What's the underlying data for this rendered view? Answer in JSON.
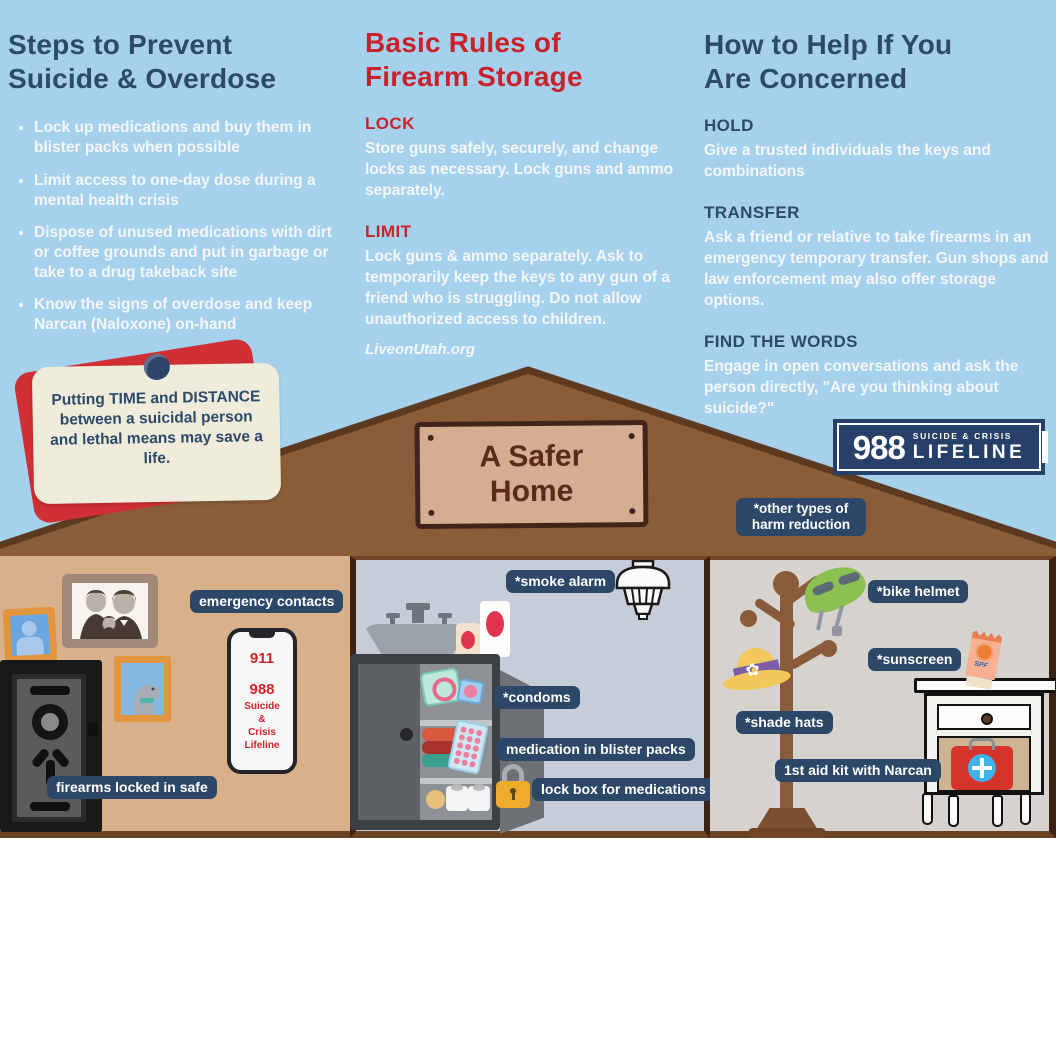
{
  "columns": {
    "prevent": {
      "title": "Steps to Prevent\nSuicide & Overdose",
      "bullets": [
        "Lock up medications and buy them in blister packs when possible",
        "Limit access to one-day dose during a mental health crisis",
        "Dispose of unused medications with dirt or coffee grounds and put in garbage or take to a drug takeback site",
        "Know the signs of overdose and keep Narcan (Naloxone) on-hand"
      ]
    },
    "firearm": {
      "title": "Basic Rules of\nFirearm Storage",
      "lock_heading": "LOCK",
      "lock_body": "Store guns safely, securely, and change locks as necessary. Lock guns and ammo separately.",
      "limit_heading": "LIMIT",
      "limit_body": "Lock guns & ammo separately. Ask to temporarily keep the keys to any gun of a friend who is struggling. Do not allow unauthorized access to children.",
      "link": "LiveonUtah.org"
    },
    "help": {
      "title": "How to Help If You\nAre Concerned",
      "hold_heading": "HOLD",
      "hold_body": "Give a trusted individuals the keys and combinations",
      "transfer_heading": "TRANSFER",
      "transfer_body": "Ask a friend or relative to take firearms in an emergency temporary transfer. Gun shops and law enforcement may also offer storage options.",
      "find_heading": "FIND THE WORDS",
      "find_body": "Engage in open conversations and ask the person directly, ",
      "find_body_bold": "\"Are you thinking about suicide?\""
    }
  },
  "note": {
    "text": "Putting TIME and DISTANCE between a suicidal person and lethal means may save a life."
  },
  "sign": {
    "text": "A Safer\nHome"
  },
  "lifeline_logo": {
    "number": "988",
    "tagline": "SUICIDE & CRISIS",
    "name": "LIFELINE"
  },
  "badges": {
    "other": "*other types of harm reduction",
    "emergency": "emergency contacts",
    "safe": "firearms locked in safe",
    "smoke": "*smoke alarm",
    "condoms": "*condoms",
    "blister": "medication in blister packs",
    "lockbox": "lock box for medications",
    "helmet": "*bike helmet",
    "sunscreen": "*sunscreen",
    "hats": "*shade hats",
    "firstaid": "1st aid kit with Narcan"
  },
  "phone": {
    "line1": "911",
    "line2": "988",
    "line3": "Suicide\n&\nCrisis\nLifeline"
  },
  "sunscreen_tube": {
    "label": "SPF"
  },
  "colors": {
    "sky": "#a5d1ec",
    "navy_heading": "#2e4a69",
    "red_heading": "#c8232c",
    "roof": "#8a5c38",
    "badge": "#2c4767",
    "logo_navy": "#264069",
    "note_red": "#d02f35",
    "note_cream": "#efecdb"
  }
}
